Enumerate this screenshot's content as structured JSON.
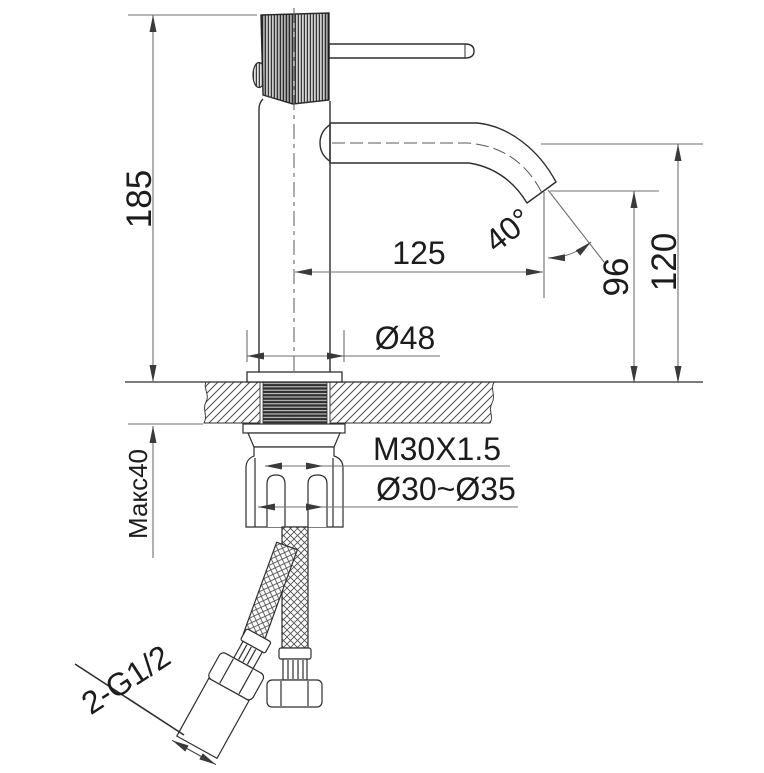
{
  "drawing": {
    "type": "faucet-installation-dimension-drawing",
    "dimensions": {
      "total_height": "185",
      "spout_reach": "125",
      "spout_angle": "40°",
      "outlet_height": "96",
      "spout_centerline_height": "120",
      "base_diameter": "Ø48",
      "mounting_thread": "M30X1.5",
      "hole_diameter_range": "Ø30~Ø35",
      "max_deck_thickness": "Макс40",
      "hose_connection": "2-G1/2"
    },
    "colors": {
      "background": "#ffffff",
      "object_line": "#2e2e2e",
      "dimension_line": "#6f6f6f",
      "text": "#1c1c1c"
    }
  }
}
